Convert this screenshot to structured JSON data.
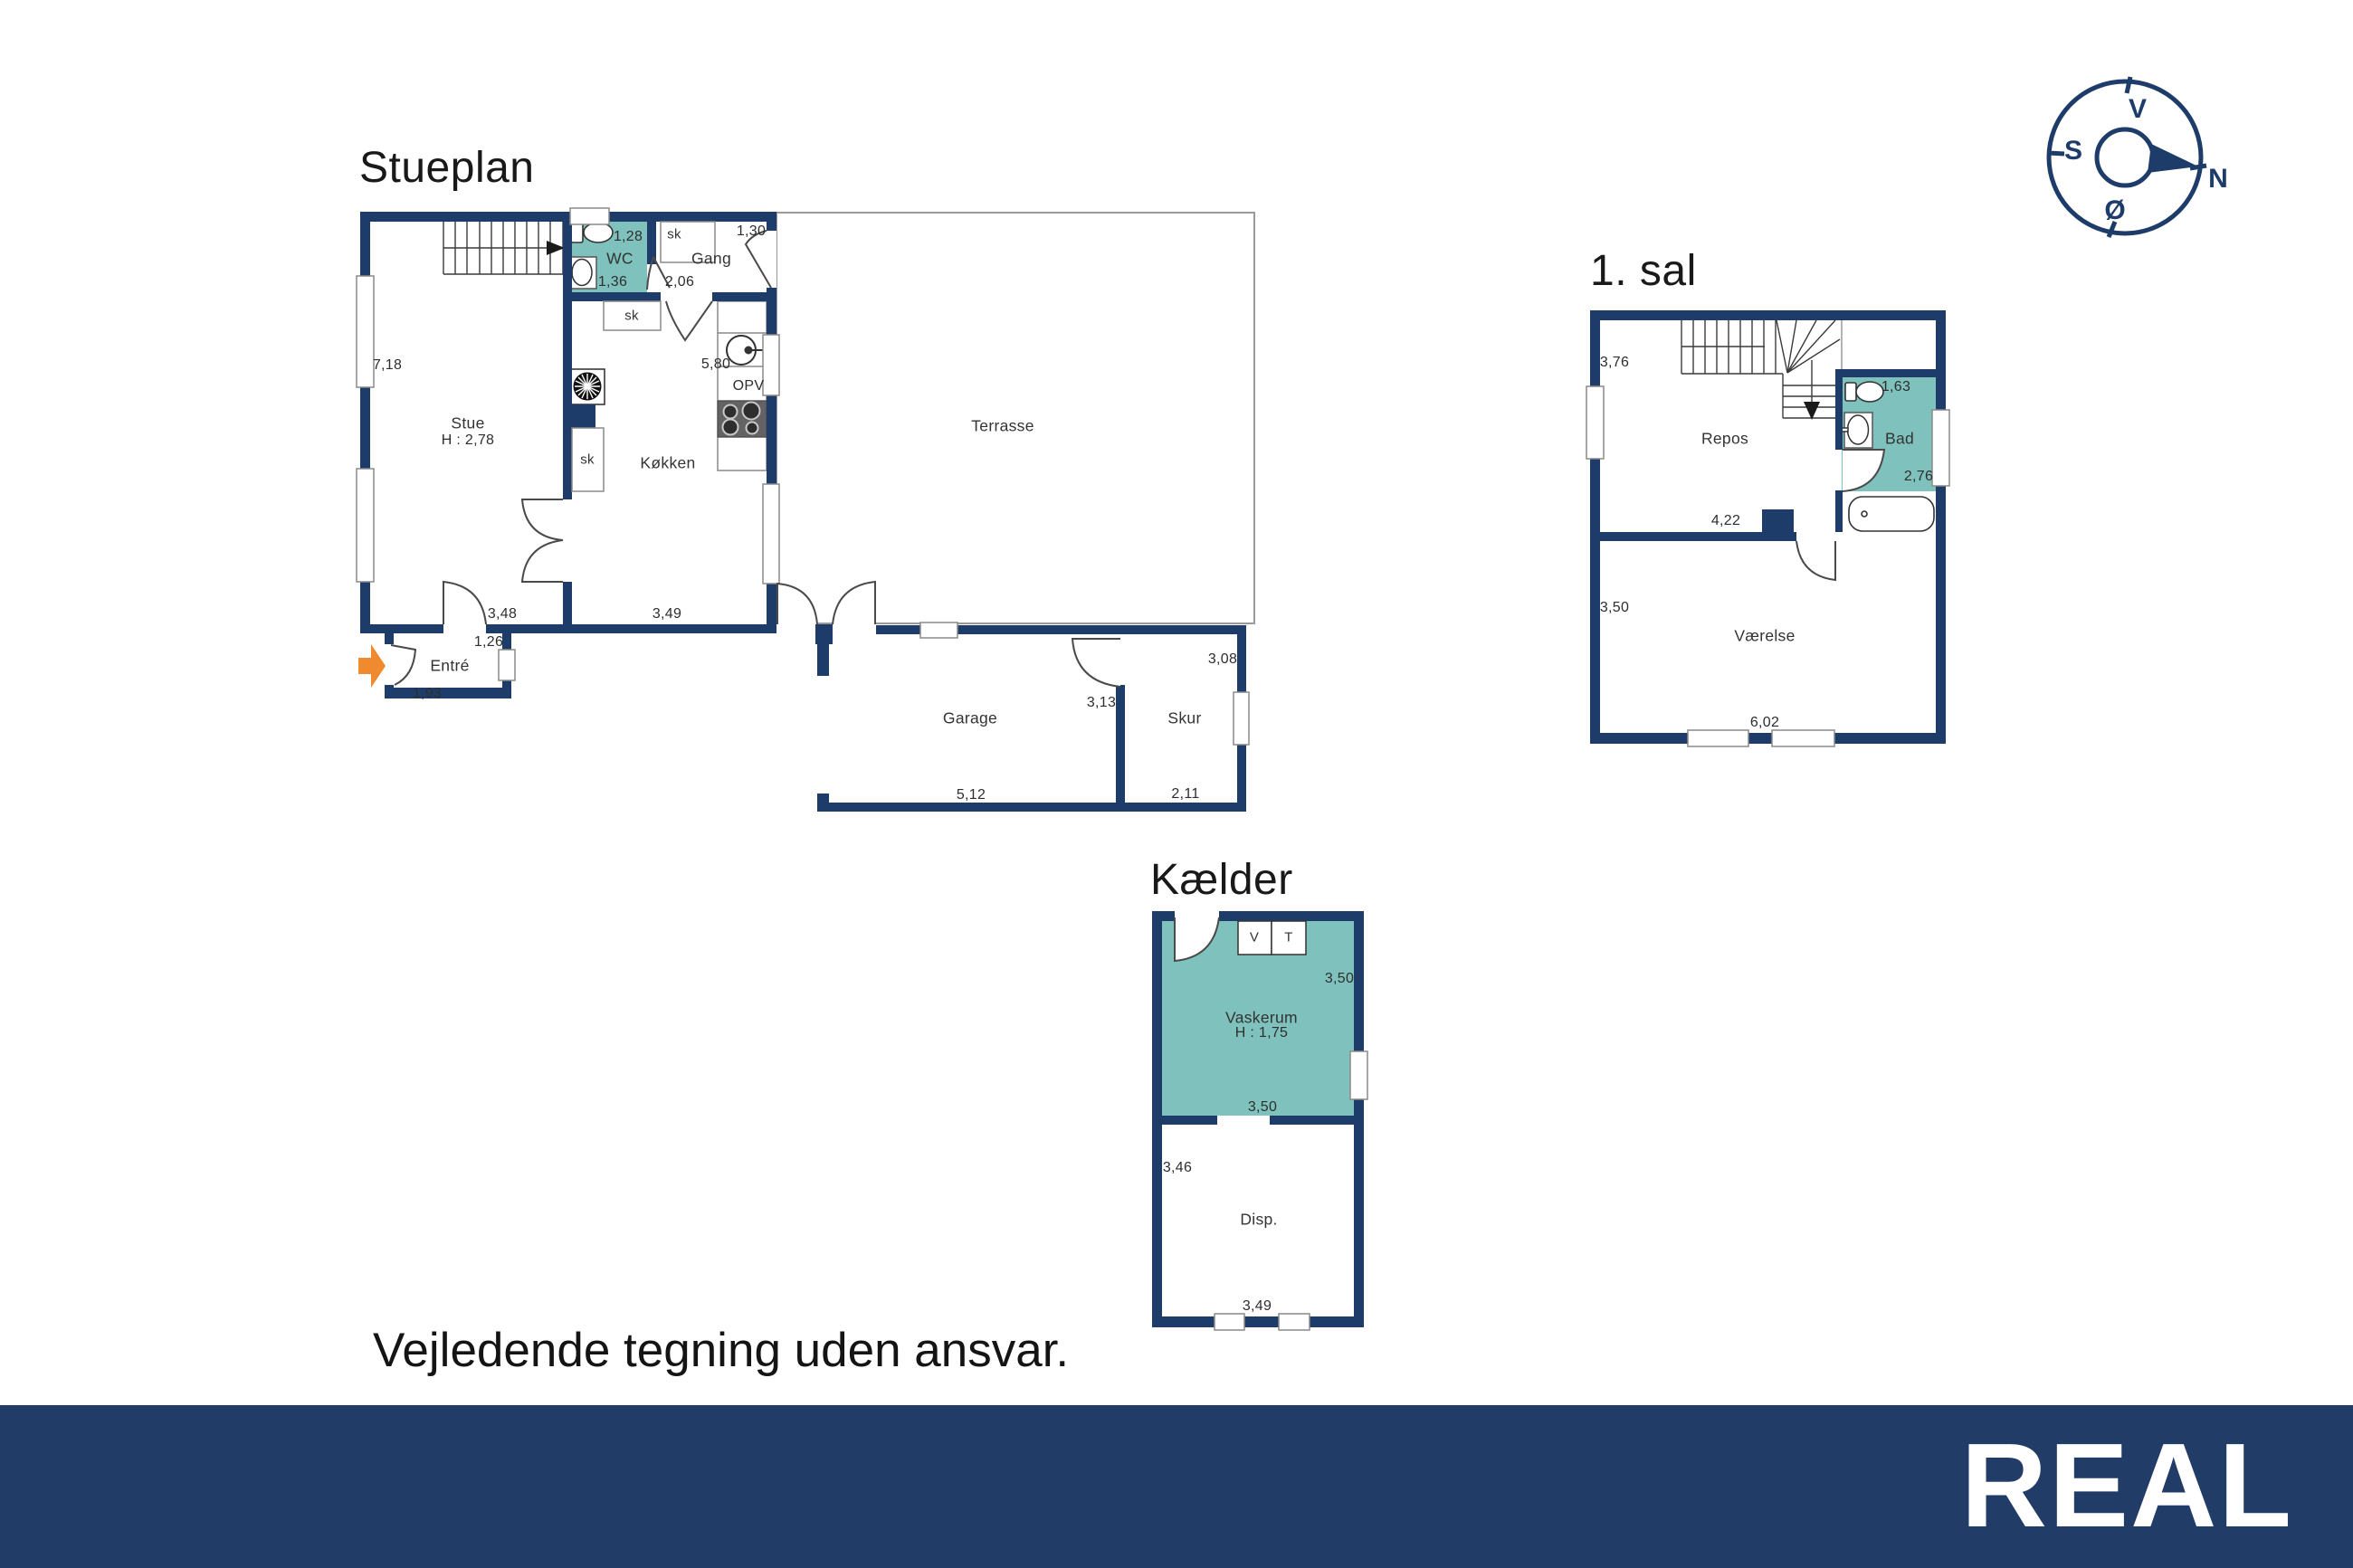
{
  "colors": {
    "wall_navy": "#1E3C6A",
    "room_teal": "#7FC2BD",
    "entrance_orange": "#EF8A2E",
    "footer_navy": "#213C66",
    "outline_gray": "#8a8a8a"
  },
  "stueplan": {
    "title": "Stueplan",
    "rooms": {
      "stue": "Stue",
      "stue_h": "H : 2,78",
      "wc": "WC",
      "gang": "Gang",
      "kokken": "Køkken",
      "entre": "Entré",
      "terrasse": "Terrasse",
      "garage": "Garage",
      "skur": "Skur"
    },
    "fixtures": {
      "sk_gang": "sk",
      "sk_kokken": "sk",
      "sk_stue": "sk",
      "opv": "OPV"
    },
    "measures": {
      "stue_left": "7,18",
      "wc_top": "1,28",
      "wc_bottom": "1,36",
      "gang_top": "1,30",
      "gang_bottom": "2,06",
      "kokken_right": "5,80",
      "stue_bottom": "3,48",
      "kokken_bottom": "3,49",
      "entre_top": "1,26",
      "entre_bottom": "1,93",
      "garage_bottom": "5,12",
      "garage_right": "3,13",
      "skur_top": "3,08",
      "skur_bottom": "2,11"
    }
  },
  "first_floor": {
    "title": "1. sal",
    "rooms": {
      "repos": "Repos",
      "bad": "Bad",
      "vaerelse": "Værelse"
    },
    "measures": {
      "repos_left": "3,76",
      "repos_bottom": "4,22",
      "bad_top": "1,63",
      "bad_right": "2,76",
      "vaerelse_left": "3,50",
      "vaerelse_bottom": "6,02"
    }
  },
  "basement": {
    "title": "Kælder",
    "rooms": {
      "vaskerum": "Vaskerum",
      "vaskerum_h": "H : 1,75",
      "disp": "Disp."
    },
    "appliances": {
      "washer": "V",
      "dryer": "T"
    },
    "measures": {
      "vaskerum_right": "3,50",
      "vaskerum_bottom": "3,50",
      "disp_left": "3,46",
      "disp_bottom": "3,49"
    }
  },
  "compass": {
    "top": "V",
    "left": "S",
    "bottom": "Ø",
    "right": "N"
  },
  "disclaimer": "Vejledende tegning uden ansvar.",
  "footer": {
    "logo": "REAL"
  }
}
